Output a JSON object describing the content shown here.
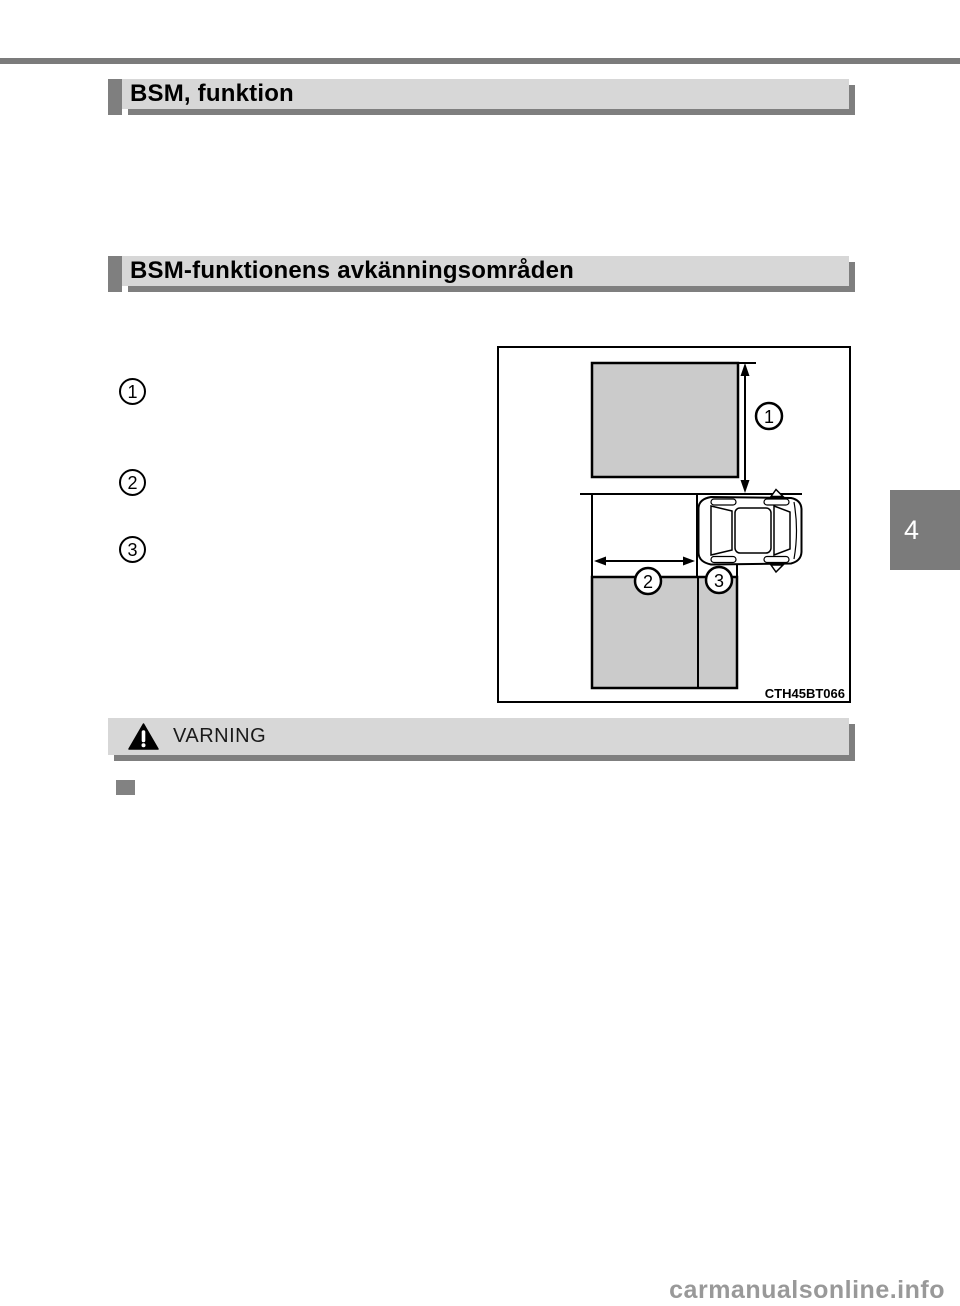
{
  "sections": {
    "header1": "BSM, funktion",
    "header2": "BSM-funktionens avkänningsområden"
  },
  "markers": {
    "items": [
      "1",
      "2",
      "3"
    ]
  },
  "diagram": {
    "callout1": "1",
    "callout2": "2",
    "callout3": "3",
    "code": "CTH45BT066"
  },
  "warning": {
    "title": "VARNING",
    "icon": "warning-triangle-icon"
  },
  "chapter_tab": {
    "number": "4"
  },
  "watermark": {
    "text": "carmanualsonline.info"
  },
  "colors": {
    "rule_gray": "#7b7b7b",
    "header_bar_gray": "#d7d7d7",
    "shadow_gray": "#7f7f7f",
    "diagram_zone_gray": "#cbcbcb",
    "bullet_gray": "#828282",
    "chapter_tab_gray": "#7b7b7b",
    "watermark_gray": "#999999"
  }
}
